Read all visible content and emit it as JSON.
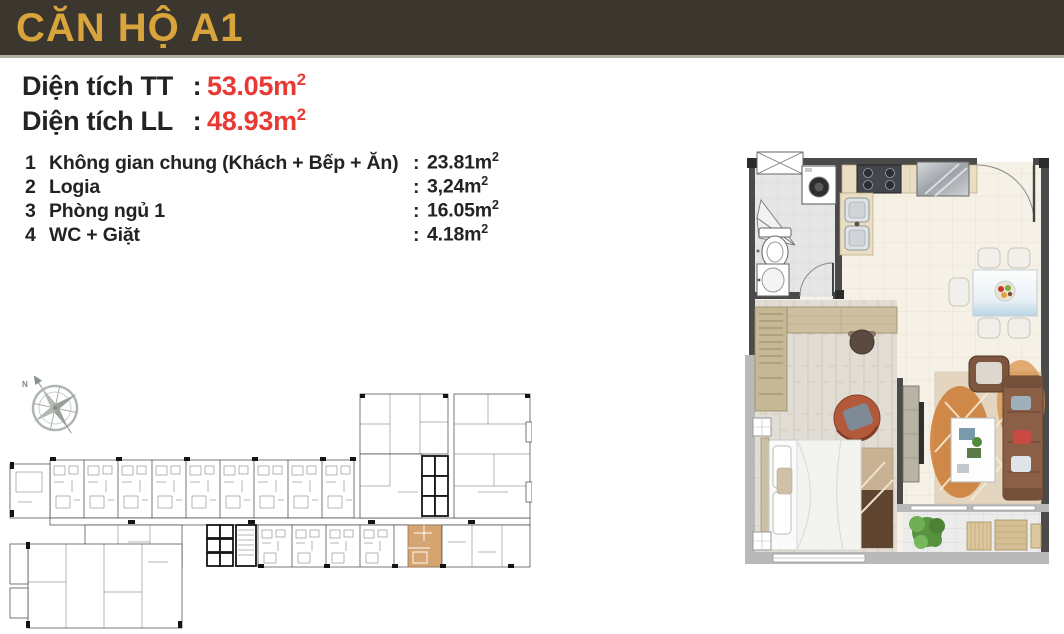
{
  "page": {
    "title": "CĂN HỘ A1",
    "colon": ":"
  },
  "areas": {
    "tt": {
      "label": "Diện tích TT",
      "value": "53.05m",
      "sup": "2"
    },
    "ll": {
      "label": "Diện tích LL",
      "value": "48.93m",
      "sup": "2"
    }
  },
  "rooms": [
    {
      "no": "1",
      "name": "Không gian chung (Khách + Bếp + Ăn)",
      "area": "23.81m",
      "sup": "2"
    },
    {
      "no": "2",
      "name": "Logia",
      "area": "3,24m",
      "sup": "2"
    },
    {
      "no": "3",
      "name": "Phòng ngủ 1",
      "area": "16.05m",
      "sup": "2"
    },
    {
      "no": "4",
      "name": "WC + Giặt",
      "area": "4.18m",
      "sup": "2"
    }
  ],
  "compass": {
    "label": "N"
  },
  "colors": {
    "header_bg": "#3b372f",
    "header_text": "#d9a43c",
    "header_divider": "#b3b0a3",
    "accent_red": "#e83934",
    "text": "#232323",
    "unit_highlight": "#d5a571",
    "plan_wall": "#4a4a4a",
    "plan_wall_light": "#b9b9b9"
  }
}
